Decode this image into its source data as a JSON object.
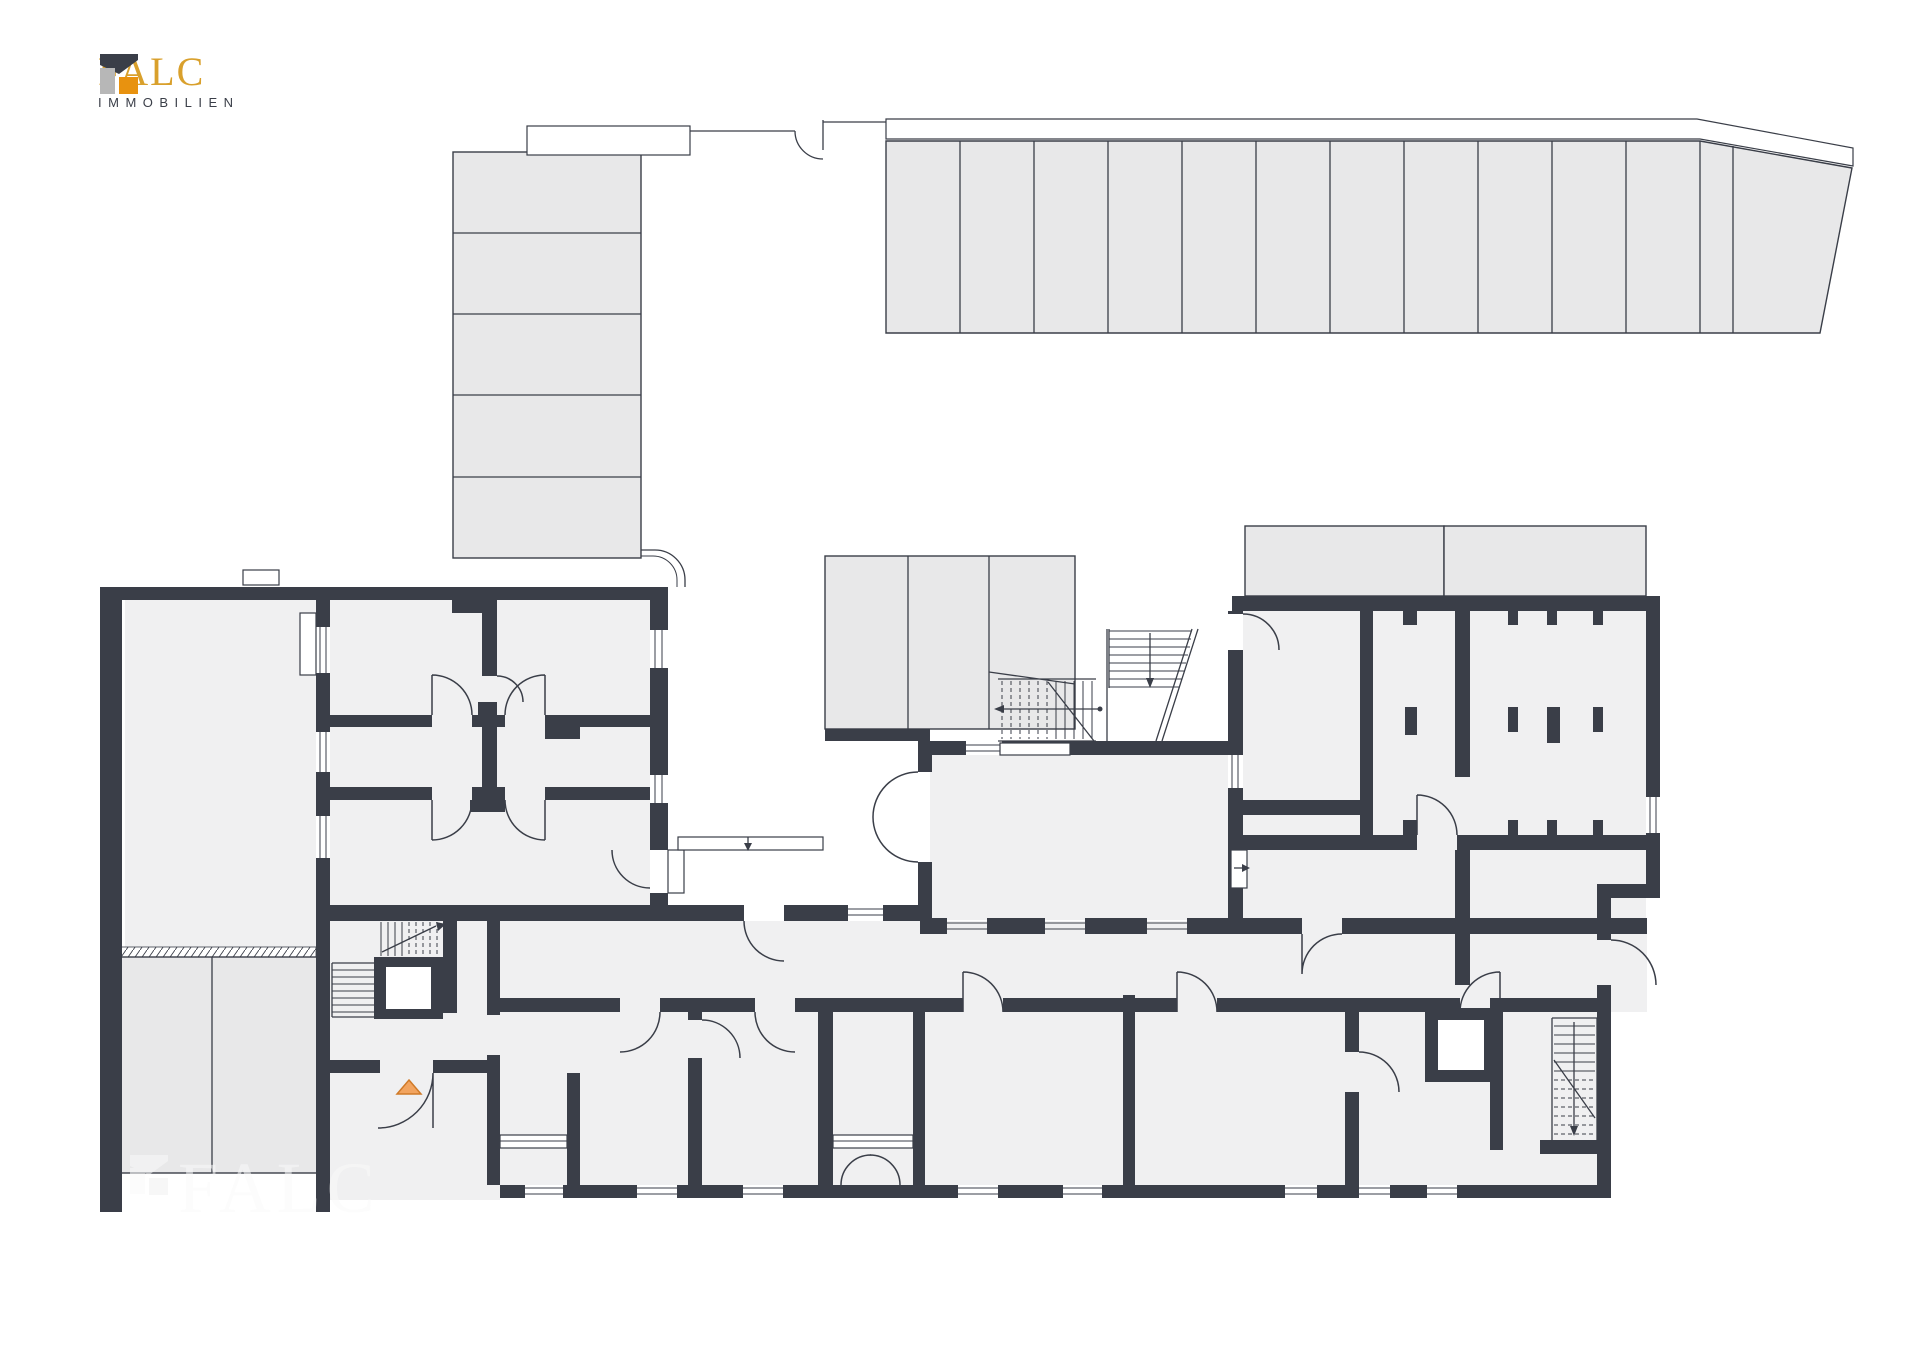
{
  "brand": {
    "name": "FALC",
    "subtitle": "IMMOBILIEN",
    "colors": {
      "gold": "#D9A02C",
      "dark": "#3A3E48",
      "gray": "#B7B7B7",
      "orange": "#E8920F"
    }
  },
  "watermark": {
    "text": "FALC"
  },
  "plan": {
    "colors": {
      "wall": "#3A3E48",
      "floor": "#F0F0F1",
      "parking": "#E8E8E9",
      "white": "#FFFFFF",
      "marker_orange": "#F2A45F",
      "marker_orange_stroke": "#D07A28"
    },
    "left_parking_stalls": 5,
    "right_parking_stalls": 12,
    "features": {
      "staircases": 3,
      "elevators": 2,
      "entrance_marker": "orange-triangle"
    }
  }
}
